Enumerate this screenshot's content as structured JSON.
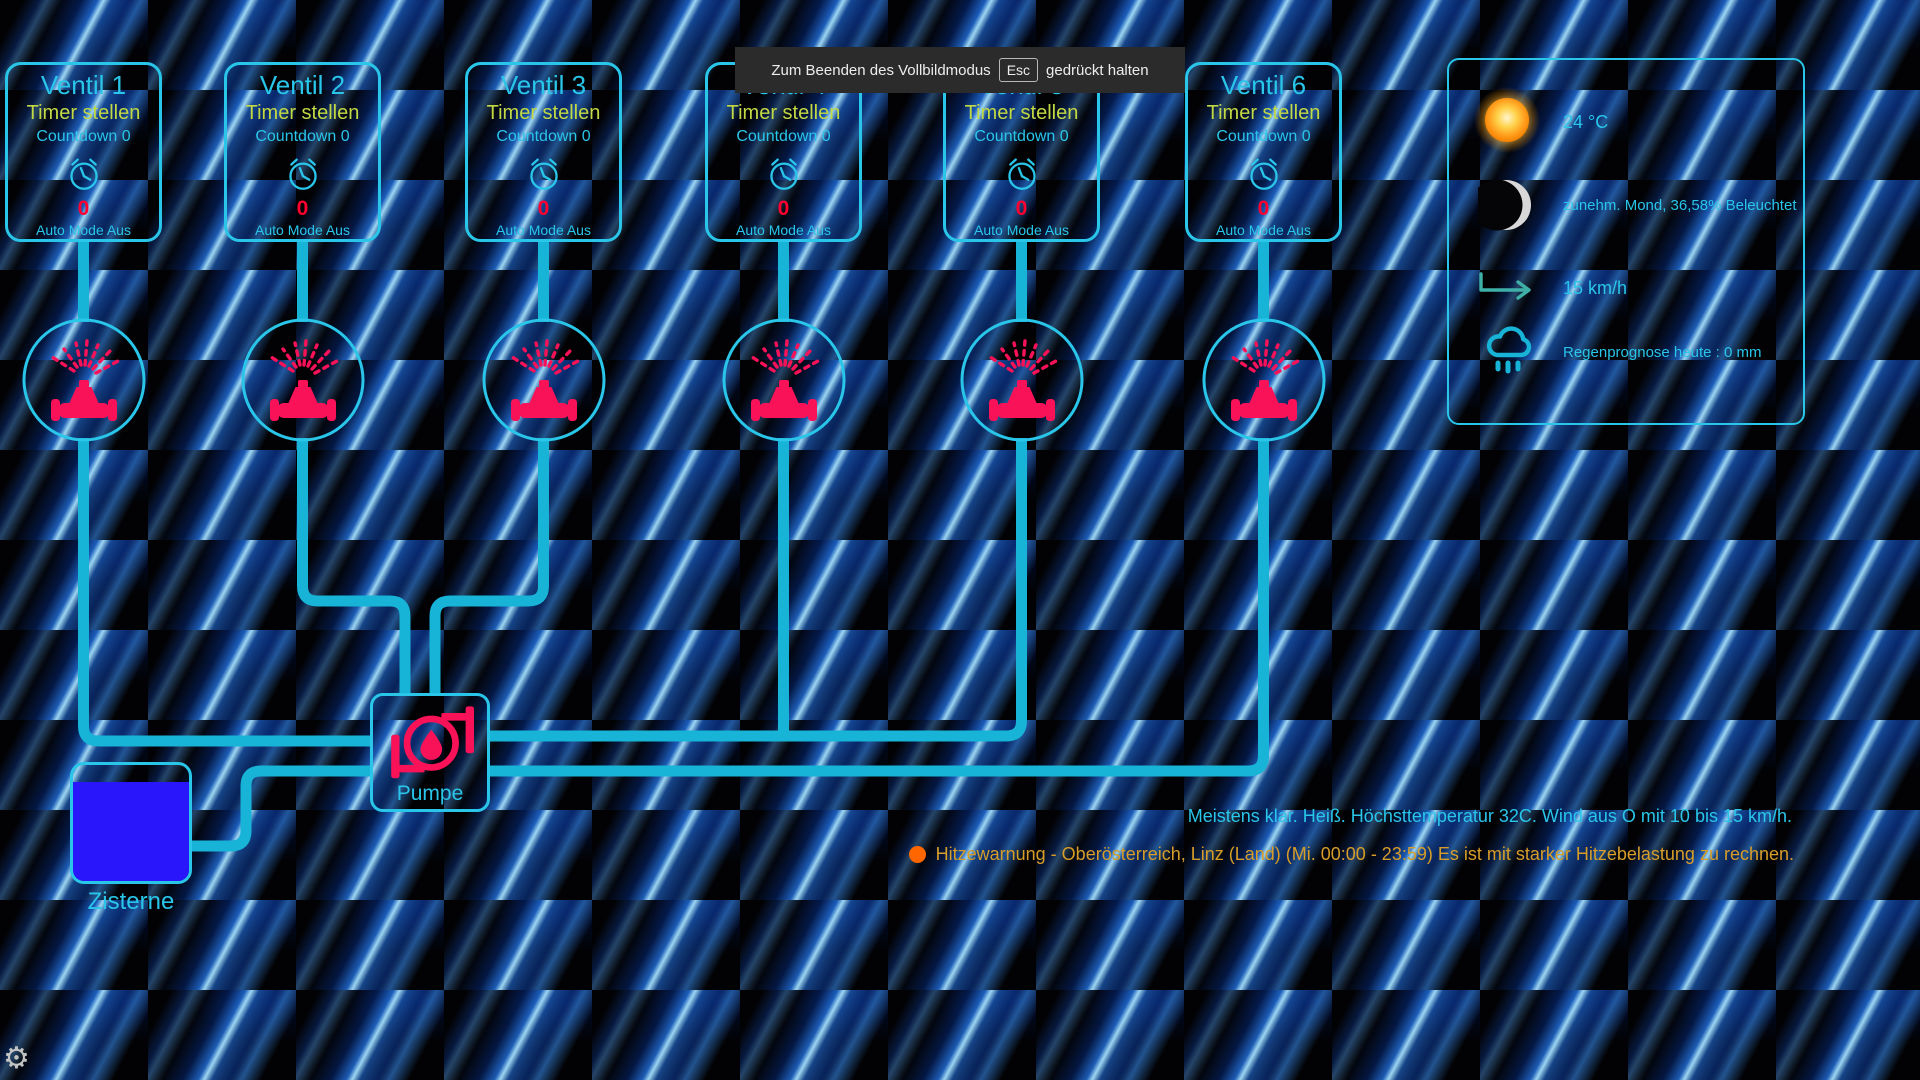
{
  "fullscreen_notice": {
    "text_before": "Zum Beenden des Vollbildmodus",
    "key": "Esc",
    "text_after": "gedrückt halten"
  },
  "valves": [
    {
      "title": "Ventil 1",
      "timer_label": "Timer stellen",
      "countdown_label": "Countdown 0",
      "value": "0",
      "mode_label": "Auto Mode Aus"
    },
    {
      "title": "Ventil 2",
      "timer_label": "Timer stellen",
      "countdown_label": "Countdown 0",
      "value": "0",
      "mode_label": "Auto Mode Aus"
    },
    {
      "title": "Ventil 3",
      "timer_label": "Timer stellen",
      "countdown_label": "Countdown 0",
      "value": "0",
      "mode_label": "Auto Mode Aus"
    },
    {
      "title": "Ventil 4",
      "timer_label": "Timer stellen",
      "countdown_label": "Countdown 0",
      "value": "0",
      "mode_label": "Auto Mode Aus"
    },
    {
      "title": "Ventil 5",
      "timer_label": "Timer stellen",
      "countdown_label": "Countdown 0",
      "value": "0",
      "mode_label": "Auto Mode Aus"
    },
    {
      "title": "Ventil 6",
      "timer_label": "Timer stellen",
      "countdown_label": "Countdown 0",
      "value": "0",
      "mode_label": "Auto Mode Aus"
    }
  ],
  "pump": {
    "label": "Pumpe"
  },
  "cistern": {
    "label": "Zisterne",
    "fill_percent": 85
  },
  "weather": {
    "temperature": "24 °C",
    "moon": "zunehm. Mond, 36,58% Beleuchtet",
    "wind": "15 km/h",
    "rain": "Regenprognose heute : 0 mm"
  },
  "status": {
    "forecast": "Meistens klar. Heiß. Höchsttemperatur 32C. Wind aus O mit 10 bis 15 km/h.",
    "warning": "Hitzewarnung - Oberösterreich, Linz (Land) (Mi. 00:00 - 23:59) Es ist mit starker Hitzebelastung zu rechnen."
  },
  "colors": {
    "accent-cyan": "#29c6ea",
    "pipe-cyan": "#17b4d8",
    "timer-green": "#c3d943",
    "count-red": "#ff0030",
    "sprinkler-pink": "#fa1258",
    "cistern-blue": "#2a16fa",
    "warning-orange": "#ff6600",
    "warning-text": "#d79d28",
    "notice-bg": "#2b2b2b"
  }
}
